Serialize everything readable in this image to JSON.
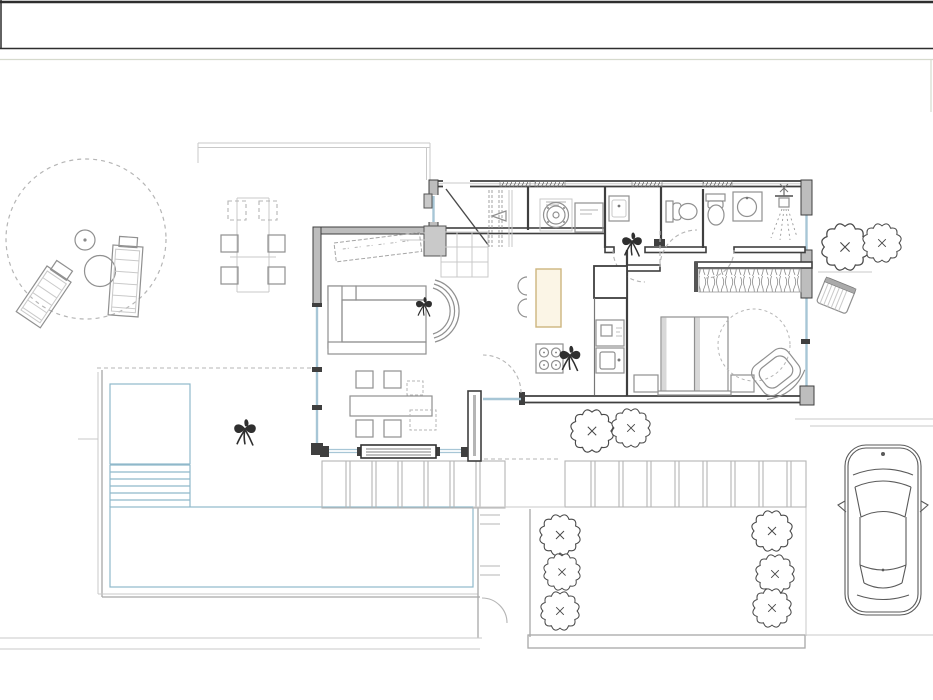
{
  "canvas": {
    "width": 933,
    "height": 700,
    "background": "#ffffff"
  },
  "colors": {
    "frame-dark": "#2e2e2e",
    "frame-light": "#d6dacd",
    "wall": "#3f3f3f",
    "wall-fill": "#bdbdbd",
    "furniture": "#909090",
    "site": "#b5b5b5",
    "glass": "#a7c6d6",
    "deck": "#8fb9ca",
    "wood": "#cdb57e",
    "wood-fill": "#fbf5e6",
    "icon-dark": "#2f2f2f"
  },
  "plan": {
    "drawing_type": "residential-floor-plan",
    "areas": [
      {
        "name": "patio-lounge-circle"
      },
      {
        "name": "outdoor-dining"
      },
      {
        "name": "entry-vestibule"
      },
      {
        "name": "wardrobe-closet"
      },
      {
        "name": "utility-room"
      },
      {
        "name": "wc"
      },
      {
        "name": "bathroom"
      },
      {
        "name": "hallway"
      },
      {
        "name": "living-room"
      },
      {
        "name": "kitchen"
      },
      {
        "name": "bedroom"
      },
      {
        "name": "south-terrace"
      },
      {
        "name": "wood-deck"
      },
      {
        "name": "garden"
      },
      {
        "name": "driveway"
      }
    ],
    "objects": [
      {
        "name": "sun-lounger"
      },
      {
        "name": "patio-table"
      },
      {
        "name": "outdoor-dining-table"
      },
      {
        "name": "entry-door"
      },
      {
        "name": "built-in-wardrobe"
      },
      {
        "name": "washing-machine"
      },
      {
        "name": "dryer"
      },
      {
        "name": "laundry-sink"
      },
      {
        "name": "toilet"
      },
      {
        "name": "washbasin"
      },
      {
        "name": "shower"
      },
      {
        "name": "sofa"
      },
      {
        "name": "lounge-chair"
      },
      {
        "name": "tv-sideboard"
      },
      {
        "name": "dining-table"
      },
      {
        "name": "kitchen-island"
      },
      {
        "name": "cooktop"
      },
      {
        "name": "oven"
      },
      {
        "name": "kitchen-sink"
      },
      {
        "name": "tall-cabinet"
      },
      {
        "name": "double-bed"
      },
      {
        "name": "nightstand"
      },
      {
        "name": "wardrobe"
      },
      {
        "name": "egg-chair"
      },
      {
        "name": "shrub"
      },
      {
        "name": "potted-plant"
      },
      {
        "name": "rain-barrel"
      },
      {
        "name": "car"
      },
      {
        "name": "sliding-glass-door"
      },
      {
        "name": "stairs"
      }
    ]
  }
}
